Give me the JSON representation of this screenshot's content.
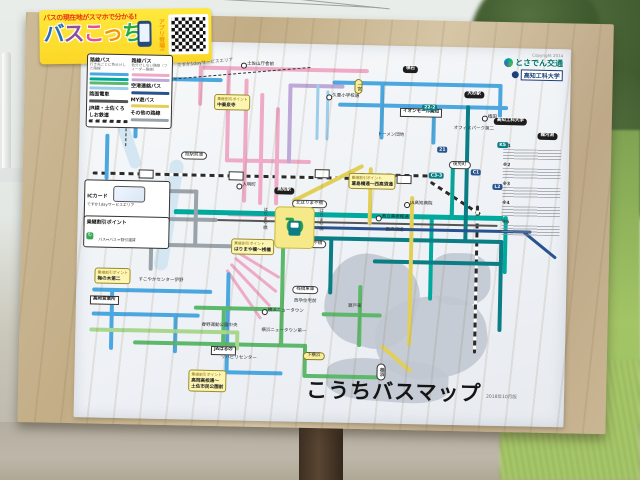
{
  "colors": {
    "pink": "#eeaac6",
    "blue": "#4aa7e0",
    "lightblue": "#9ccdea",
    "teal": "#00a99d",
    "darkteal": "#0a7d85",
    "green": "#5cb86a",
    "lightgreen": "#a9d78f",
    "yellow": "#e2cf58",
    "gray": "#9aa2aa",
    "navy": "#27538f",
    "purple": "#bda8d8",
    "tram": "#555555",
    "board": "#c9b592",
    "banner_yellow": "#ffe93d",
    "banner_red": "#e8380d"
  },
  "banner": {
    "catch": "バスの現在地がスマホで分かる!",
    "title": "バスこっち",
    "sub": "アプリ登場!"
  },
  "poster": {
    "title": "こうちバスマップ",
    "edition": "2018年10月版",
    "credits": {
      "copyright": "Copyright 2014",
      "org1": "とさでん交通",
      "org2": "高知工科大学"
    },
    "area_label": "ですか1dayサービスエリア",
    "legend": {
      "col1": {
        "label": "路線バス",
        "desc": "行き先ごとに色分けした路線",
        "swatches": [
          "#4aa7e0",
          "#00a99d",
          "#5cb86a",
          "#9ccdea"
        ],
        "extra": [
          {
            "label": "路面電車",
            "sw": "#555555"
          },
          {
            "label": "JR線・土佐くろしお鉄道",
            "sw": "jr"
          }
        ]
      },
      "col2": {
        "label": "路線バス",
        "desc": "色分けしない路線（フィーダー路線）",
        "swatches": [
          "#eeaac6",
          "#bda8d8"
        ],
        "extra": [
          {
            "label": "空港連絡バス",
            "sw": "#27538f"
          },
          {
            "label": "MY遊バス",
            "sw": "#e2cf58"
          },
          {
            "label": "その他の路線",
            "sw": "#9aa2aa"
          }
        ]
      },
      "ic": {
        "label": "ICカード",
        "line1": "ですか1dayサービスエリア",
        "line2": "1日500円乗り放題"
      },
      "transfer": {
        "label": "乗継割引ポイント",
        "desc": "バス⇔バス＝割引運賃"
      }
    },
    "notes": {
      "items": [
        "※1",
        "※2",
        "※3",
        "※4",
        "※5"
      ]
    },
    "water": [
      {
        "x": 250,
        "y": 210,
        "w": 92,
        "h": 92,
        "r": 15,
        "br": 42
      },
      {
        "x": 300,
        "y": 250,
        "w": 112,
        "h": 82,
        "r": -8,
        "br": 45
      },
      {
        "x": 352,
        "y": 206,
        "w": 62,
        "h": 52,
        "r": 0,
        "br": 40
      },
      {
        "x": 252,
        "y": 314,
        "w": 122,
        "h": 42,
        "r": 3,
        "br": 35
      }
    ],
    "rivers": [
      {
        "x": 84,
        "y": 118,
        "w": 14,
        "h": 112,
        "r": 8
      },
      {
        "x": 40,
        "y": 58,
        "w": 12,
        "h": 72,
        "r": -20
      }
    ],
    "routes": [
      {
        "x": 14,
        "y": 132,
        "w": 260,
        "h": 3,
        "c": "jr"
      },
      {
        "x": 272,
        "y": 128,
        "w": 86,
        "h": 3,
        "c": "jr"
      },
      {
        "x": 352,
        "y": 134,
        "w": 62,
        "h": 3,
        "c": "jr",
        "rot": 32
      },
      {
        "x": 398,
        "y": 158,
        "w": 3,
        "h": 148,
        "c": "jrv"
      },
      {
        "x": 118,
        "y": 24,
        "w": 170,
        "h": 4,
        "c": "pink"
      },
      {
        "x": 118,
        "y": 24,
        "w": 4,
        "h": 40,
        "c": "pink"
      },
      {
        "x": 146,
        "y": 24,
        "w": 4,
        "h": 96,
        "c": "pink"
      },
      {
        "x": 164,
        "y": 36,
        "w": 4,
        "h": 124,
        "c": "pink"
      },
      {
        "x": 180,
        "y": 50,
        "w": 4,
        "h": 112,
        "c": "pink"
      },
      {
        "x": 196,
        "y": 64,
        "w": 4,
        "h": 98,
        "c": "pink"
      },
      {
        "x": 146,
        "y": 116,
        "w": 86,
        "h": 4,
        "c": "pink"
      },
      {
        "x": 150,
        "y": 170,
        "w": 56,
        "h": 4,
        "c": "pink"
      },
      {
        "x": 160,
        "y": 208,
        "w": 50,
        "h": 3,
        "c": "pink",
        "rot": 30
      },
      {
        "x": 158,
        "y": 214,
        "w": 54,
        "h": 3,
        "c": "pink",
        "rot": 38
      },
      {
        "x": 154,
        "y": 220,
        "w": 58,
        "h": 3,
        "c": "pink",
        "rot": 46
      },
      {
        "x": 150,
        "y": 226,
        "w": 60,
        "h": 3,
        "c": "pink",
        "rot": 54
      },
      {
        "x": 208,
        "y": 40,
        "w": 4,
        "h": 80,
        "c": "purple"
      },
      {
        "x": 208,
        "y": 40,
        "w": 56,
        "h": 4,
        "c": "purple"
      },
      {
        "x": 252,
        "y": 36,
        "w": 170,
        "h": 4,
        "c": "blue"
      },
      {
        "x": 418,
        "y": 36,
        "w": 4,
        "h": 34,
        "c": "blue"
      },
      {
        "x": 258,
        "y": 58,
        "w": 170,
        "h": 4,
        "c": "blue"
      },
      {
        "x": 300,
        "y": 36,
        "w": 4,
        "h": 58,
        "c": "blue"
      },
      {
        "x": 352,
        "y": 58,
        "w": 4,
        "h": 40,
        "c": "blue"
      },
      {
        "x": 54,
        "y": 36,
        "w": 4,
        "h": 62,
        "c": "blue"
      },
      {
        "x": 54,
        "y": 36,
        "w": 88,
        "h": 4,
        "c": "blue"
      },
      {
        "x": 26,
        "y": 94,
        "w": 4,
        "h": 46,
        "c": "blue"
      },
      {
        "x": 16,
        "y": 248,
        "w": 120,
        "h": 4,
        "c": "blue"
      },
      {
        "x": 34,
        "y": 248,
        "w": 4,
        "h": 62,
        "c": "blue"
      },
      {
        "x": 16,
        "y": 272,
        "w": 108,
        "h": 4,
        "c": "blue"
      },
      {
        "x": 98,
        "y": 272,
        "w": 4,
        "h": 40,
        "c": "blue"
      },
      {
        "x": 150,
        "y": 230,
        "w": 4,
        "h": 100,
        "c": "blue"
      },
      {
        "x": 150,
        "y": 328,
        "w": 58,
        "h": 4,
        "c": "blue"
      },
      {
        "x": 236,
        "y": 40,
        "w": 3,
        "h": 56,
        "c": "lightblue"
      },
      {
        "x": 246,
        "y": 46,
        "w": 3,
        "h": 50,
        "c": "lightblue"
      },
      {
        "x": 96,
        "y": 168,
        "w": 330,
        "h": 5,
        "c": "teal"
      },
      {
        "x": 352,
        "y": 168,
        "w": 4,
        "h": 86,
        "c": "teal"
      },
      {
        "x": 372,
        "y": 120,
        "w": 4,
        "h": 52,
        "c": "teal"
      },
      {
        "x": 426,
        "y": 168,
        "w": 4,
        "h": 58,
        "c": "teal"
      },
      {
        "x": 120,
        "y": 177,
        "w": 300,
        "h": 2,
        "c": "tram"
      },
      {
        "x": 210,
        "y": 192,
        "w": 216,
        "h": 4,
        "c": "darkteal"
      },
      {
        "x": 386,
        "y": 58,
        "w": 4,
        "h": 136,
        "c": "darkteal"
      },
      {
        "x": 296,
        "y": 214,
        "w": 130,
        "h": 4,
        "c": "darkteal"
      },
      {
        "x": 422,
        "y": 192,
        "w": 4,
        "h": 92,
        "c": "darkteal"
      },
      {
        "x": 252,
        "y": 192,
        "w": 4,
        "h": 58,
        "c": "darkteal"
      },
      {
        "x": 204,
        "y": 198,
        "w": 4,
        "h": 106,
        "c": "green"
      },
      {
        "x": 118,
        "y": 264,
        "w": 90,
        "h": 4,
        "c": "green"
      },
      {
        "x": 146,
        "y": 264,
        "w": 4,
        "h": 40,
        "c": "green"
      },
      {
        "x": 58,
        "y": 300,
        "w": 174,
        "h": 4,
        "c": "green"
      },
      {
        "x": 228,
        "y": 300,
        "w": 4,
        "h": 32,
        "c": "green"
      },
      {
        "x": 228,
        "y": 330,
        "w": 76,
        "h": 4,
        "c": "green"
      },
      {
        "x": 282,
        "y": 240,
        "w": 4,
        "h": 62,
        "c": "green"
      },
      {
        "x": 246,
        "y": 268,
        "w": 60,
        "h": 4,
        "c": "green"
      },
      {
        "x": 14,
        "y": 288,
        "w": 150,
        "h": 4,
        "c": "lightgreen"
      },
      {
        "x": 160,
        "y": 288,
        "w": 4,
        "h": 20,
        "c": "lightgreen"
      },
      {
        "x": 214,
        "y": 156,
        "w": 80,
        "h": 4,
        "c": "yellow",
        "rot": -28
      },
      {
        "x": 290,
        "y": 122,
        "w": 4,
        "h": 58,
        "c": "yellow"
      },
      {
        "x": 332,
        "y": 150,
        "w": 4,
        "h": 150,
        "c": "yellow"
      },
      {
        "x": 306,
        "y": 298,
        "w": 40,
        "h": 4,
        "c": "yellow",
        "rot": 40
      },
      {
        "x": 36,
        "y": 176,
        "w": 104,
        "h": 4,
        "c": "gray"
      },
      {
        "x": 72,
        "y": 176,
        "w": 4,
        "h": 54,
        "c": "gray"
      },
      {
        "x": 36,
        "y": 202,
        "w": 124,
        "h": 4,
        "c": "gray"
      },
      {
        "x": 116,
        "y": 148,
        "w": 4,
        "h": 58,
        "c": "gray"
      },
      {
        "x": 36,
        "y": 148,
        "w": 84,
        "h": 4,
        "c": "gray"
      },
      {
        "x": 36,
        "y": 148,
        "w": 4,
        "h": 58,
        "c": "gray"
      },
      {
        "x": 214,
        "y": 182,
        "w": 240,
        "h": 3,
        "c": "navy"
      },
      {
        "x": 446,
        "y": 182,
        "w": 42,
        "h": 3,
        "c": "navy",
        "rot": 38
      }
    ],
    "stations": [
      {
        "x": 60,
        "y": 129
      },
      {
        "x": 150,
        "y": 129
      },
      {
        "x": 236,
        "y": 125
      },
      {
        "x": 318,
        "y": 129
      }
    ],
    "stops": [
      {
        "t": "土佐山庁舎前",
        "x": 160,
        "y": 20,
        "type": "circle"
      },
      {
        "t": "久重小学校通",
        "x": 246,
        "y": 50,
        "type": "circle"
      },
      {
        "t": "イオンモール高知",
        "x": 320,
        "y": 62,
        "type": "box"
      },
      {
        "t": "領石",
        "x": 322,
        "y": 20,
        "type": "black"
      },
      {
        "t": "大杉駅",
        "x": 384,
        "y": 44,
        "type": "black"
      },
      {
        "t": "植田",
        "x": 402,
        "y": 68,
        "type": "circle"
      },
      {
        "t": "オフィスパーク第二",
        "x": 374,
        "y": 80,
        "type": "plain"
      },
      {
        "t": "トーメン団地",
        "x": 298,
        "y": 88,
        "type": "plain"
      },
      {
        "t": "高知工科大学",
        "x": 414,
        "y": 70,
        "type": "black"
      },
      {
        "t": "龍河洞",
        "x": 458,
        "y": 84,
        "type": "black"
      },
      {
        "t": "後免町",
        "x": 370,
        "y": 114,
        "type": "pill"
      },
      {
        "t": "高知駅",
        "x": 196,
        "y": 144,
        "type": "black"
      },
      {
        "t": "北はりまや橋",
        "x": 214,
        "y": 156,
        "type": "pill"
      },
      {
        "t": "南はりまや橋",
        "x": 214,
        "y": 196,
        "type": "pill"
      },
      {
        "t": "入明町",
        "x": 158,
        "y": 141,
        "type": "circle"
      },
      {
        "t": "旭駅前通",
        "x": 102,
        "y": 110,
        "type": "pill"
      },
      {
        "t": "土居",
        "x": 14,
        "y": 164,
        "type": "pill"
      },
      {
        "t": "JA高知病院",
        "x": 326,
        "y": 156,
        "type": "circle"
      },
      {
        "t": "県立美術館通",
        "x": 298,
        "y": 170,
        "type": "circle"
      },
      {
        "t": "西高須通",
        "x": 308,
        "y": 183,
        "type": "plain"
      },
      {
        "t": "桟橋車庫",
        "x": 216,
        "y": 242,
        "type": "pill"
      },
      {
        "t": "西孕住宅前",
        "x": 218,
        "y": 256,
        "type": "plain"
      },
      {
        "t": "横浜ニュータウン",
        "x": 186,
        "y": 266,
        "type": "circle"
      },
      {
        "t": "横浜ニュータウン第一",
        "x": 186,
        "y": 286,
        "type": "plain"
      },
      {
        "t": "瀬戸東",
        "x": 272,
        "y": 260,
        "type": "plain"
      },
      {
        "t": "リハビリセンター",
        "x": 146,
        "y": 314,
        "type": "plain"
      },
      {
        "t": "下横浜",
        "x": 228,
        "y": 308,
        "type": "ypill"
      },
      {
        "t": "桂浜",
        "x": 302,
        "y": 318,
        "type": "vpill"
      },
      {
        "t": "高岡営業所",
        "x": 14,
        "y": 256,
        "type": "box"
      },
      {
        "t": "JAはるの",
        "x": 136,
        "y": 304,
        "type": "box"
      },
      {
        "t": "春野運動公園中央",
        "x": 126,
        "y": 282,
        "type": "plain"
      },
      {
        "t": "すこやかセンター伊野",
        "x": 62,
        "y": 238,
        "type": "plain"
      },
      {
        "t": "伊野駅",
        "x": 54,
        "y": 194,
        "type": "circle"
      },
      {
        "t": "一宮",
        "x": 274,
        "y": 34,
        "type": "vypill"
      },
      {
        "t": "はりまや橋",
        "x": 184,
        "y": 164,
        "type": "vplain"
      },
      {
        "t": "はりまや橋",
        "x": 240,
        "y": 164,
        "type": "vplain"
      }
    ],
    "callouts": [
      {
        "x": 134,
        "y": 52,
        "lines": [
          "乗継割引ポイント",
          "中秦泉寺"
        ]
      },
      {
        "x": 154,
        "y": 196,
        "lines": [
          "乗継割引ポイント",
          "はりまや橋～桟橋"
        ]
      },
      {
        "x": 270,
        "y": 128,
        "lines": [
          "乗継割引ポイント",
          "葛島橋通～西高須通"
        ]
      },
      {
        "x": 38,
        "y": 170,
        "lines": [
          "乗継割引ポイント",
          "伊野駅"
        ]
      },
      {
        "x": 18,
        "y": 228,
        "lines": [
          "乗継割引ポイント",
          "梅の木第二"
        ]
      },
      {
        "x": 114,
        "y": 328,
        "lines": [
          "乗継割引ポイント",
          "高岡高校通～",
          "土佐市民公園前"
        ]
      }
    ],
    "badges": [
      {
        "t": "21",
        "x": 358,
        "y": 100
      },
      {
        "t": "22-2",
        "x": 342,
        "y": 58
      },
      {
        "t": "C1",
        "x": 392,
        "y": 122
      },
      {
        "t": "C3-3",
        "x": 350,
        "y": 126
      },
      {
        "t": "L2",
        "x": 414,
        "y": 136
      },
      {
        "t": "K5",
        "x": 418,
        "y": 94
      }
    ]
  }
}
